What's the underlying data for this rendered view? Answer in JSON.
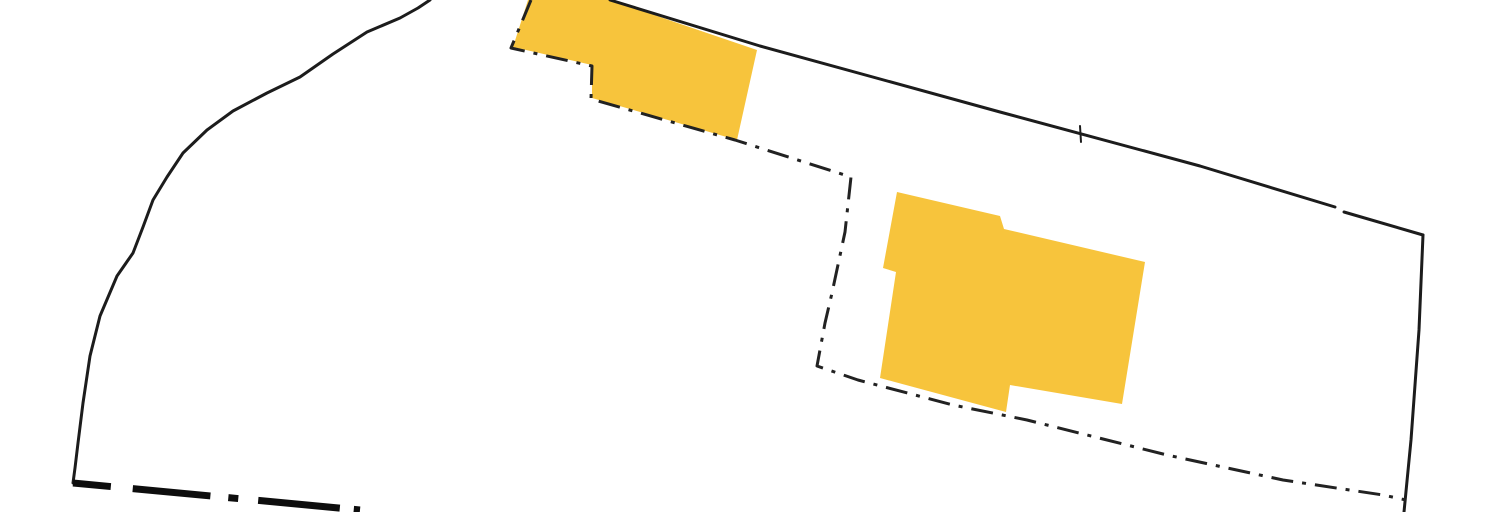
{
  "map": {
    "type": "cadastral-parcel-map",
    "canvas": {
      "width": 1504,
      "height": 512,
      "background": "#FFFFFF"
    },
    "colors": {
      "building_fill": "#F7C43C",
      "boundary_line": "#1C1C1C",
      "heavy_boundary_line": "#0D0D0D"
    },
    "buildings": [
      {
        "id": "building-footprint-north",
        "fill": "#F7C43C",
        "points": [
          [
            528,
            0
          ],
          [
            610,
            0
          ],
          [
            757,
            50
          ],
          [
            737,
            140
          ],
          [
            592,
            98
          ],
          [
            592,
            65
          ],
          [
            513,
            47
          ]
        ]
      },
      {
        "id": "building-footprint-central",
        "fill": "#F7C43C",
        "points": [
          [
            897,
            192
          ],
          [
            1000,
            216
          ],
          [
            1004,
            229
          ],
          [
            1145,
            262
          ],
          [
            1122,
            404
          ],
          [
            1010,
            385
          ],
          [
            1006,
            412
          ],
          [
            880,
            378
          ],
          [
            896,
            272
          ],
          [
            883,
            268
          ]
        ]
      }
    ],
    "boundaries": [
      {
        "id": "parcel-boundary-west-curve",
        "style": "solid",
        "stroke": "#1C1C1C",
        "stroke_width": 3,
        "points": [
          [
            430,
            0
          ],
          [
            418,
            8
          ],
          [
            400,
            18
          ],
          [
            367,
            32
          ],
          [
            333,
            54
          ],
          [
            300,
            77
          ],
          [
            267,
            93
          ],
          [
            233,
            111
          ],
          [
            207,
            130
          ],
          [
            183,
            153
          ],
          [
            167,
            177
          ],
          [
            153,
            200
          ],
          [
            143,
            227
          ],
          [
            133,
            253
          ],
          [
            117,
            276
          ],
          [
            100,
            316
          ],
          [
            90,
            356
          ],
          [
            83,
            403
          ],
          [
            78,
            443
          ],
          [
            75,
            468
          ],
          [
            73,
            483
          ]
        ]
      },
      {
        "id": "parcel-boundary-north",
        "style": "solid",
        "stroke": "#1C1C1C",
        "stroke_width": 3,
        "points": [
          [
            610,
            0
          ],
          [
            760,
            46
          ],
          [
            1000,
            112
          ],
          [
            1200,
            166
          ],
          [
            1335,
            207
          ]
        ]
      },
      {
        "id": "parcel-boundary-north-continuation",
        "style": "solid",
        "stroke": "#1C1C1C",
        "stroke_width": 3,
        "points": [
          [
            1344,
            212
          ],
          [
            1423,
            235
          ]
        ]
      },
      {
        "id": "parcel-boundary-east",
        "style": "solid",
        "stroke": "#1C1C1C",
        "stroke_width": 3,
        "points": [
          [
            1423,
            235
          ],
          [
            1419,
            330
          ],
          [
            1411,
            440
          ],
          [
            1404,
            512
          ]
        ]
      },
      {
        "id": "parcel-boundary-south-heavy",
        "style": "dash-dot-heavy",
        "stroke": "#0D0D0D",
        "stroke_width": 7,
        "dasharray": "38 22 78 18 10 20 82 14",
        "points": [
          [
            73,
            483
          ],
          [
            360,
            510
          ]
        ]
      },
      {
        "id": "inner-parcel-limit-dash-dot",
        "style": "dash-dot",
        "stroke": "#222222",
        "stroke_width": 3,
        "dasharray": "22 9 4 9",
        "points": [
          [
            531,
            0
          ],
          [
            511,
            48
          ],
          [
            592,
            66
          ],
          [
            591,
            99
          ],
          [
            735,
            140
          ],
          [
            851,
            177
          ],
          [
            845,
            232
          ],
          [
            832,
            293
          ],
          [
            825,
            323
          ],
          [
            817,
            366
          ],
          [
            858,
            380
          ],
          [
            953,
            405
          ],
          [
            1027,
            420
          ],
          [
            1167,
            455
          ],
          [
            1283,
            480
          ],
          [
            1383,
            495
          ],
          [
            1406,
            500
          ]
        ]
      }
    ],
    "markers": [
      {
        "id": "survey-tick-north-boundary",
        "stroke": "#1C1C1C",
        "stroke_width": 2,
        "points": [
          [
            1080,
            126
          ],
          [
            1081,
            142
          ]
        ]
      }
    ]
  }
}
